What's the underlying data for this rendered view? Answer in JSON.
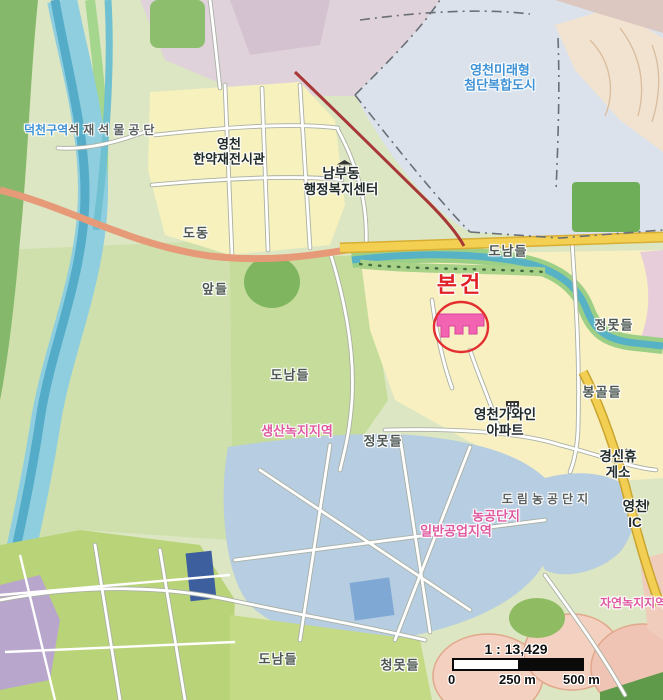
{
  "labels": {
    "future_city": "영천미래형\n첨단복합도시",
    "district_prefix": "덕천구역",
    "stone_complex": "석재석물공단",
    "herb_exhibition": "영천\n한약재전시관",
    "nambu_welfare_center": "남부동\n행정복지센터",
    "dodong": "도동",
    "donam_fields_ne": "도남들",
    "ap_fields": "앞들",
    "jeongmot_fields_east": "정못들",
    "bonggol_fields": "봉골들",
    "donam_fields_center": "도남들",
    "gawain_apartment": "영천가와인\n아파트",
    "production_green_zone": "생산녹지지역",
    "jeongmot_fields_center": "정못들",
    "gyeongsin_rest_area": "경신휴게소",
    "dorim_agro_complex": "도림농공단지",
    "agro_complex": "농공단지",
    "general_industrial_zone": "일반공업지역",
    "yeongcheon_ic": "영천IC",
    "natural_green_zone": "자연녹지지역",
    "donam_fields_sw": "도남들",
    "cheongmot_fields": "청못들"
  },
  "marker": {
    "label": "본건"
  },
  "scale_bar": {
    "ratio": "1 : 13,429",
    "tick_zero": "0",
    "tick_mid": "250 m",
    "tick_end": "500 m"
  },
  "colors": {
    "marker_red": "#e02127",
    "zoning_pink": "#df58a0",
    "admin_blue": "#3f92d6",
    "subject_building_pink": "#f263b2"
  }
}
